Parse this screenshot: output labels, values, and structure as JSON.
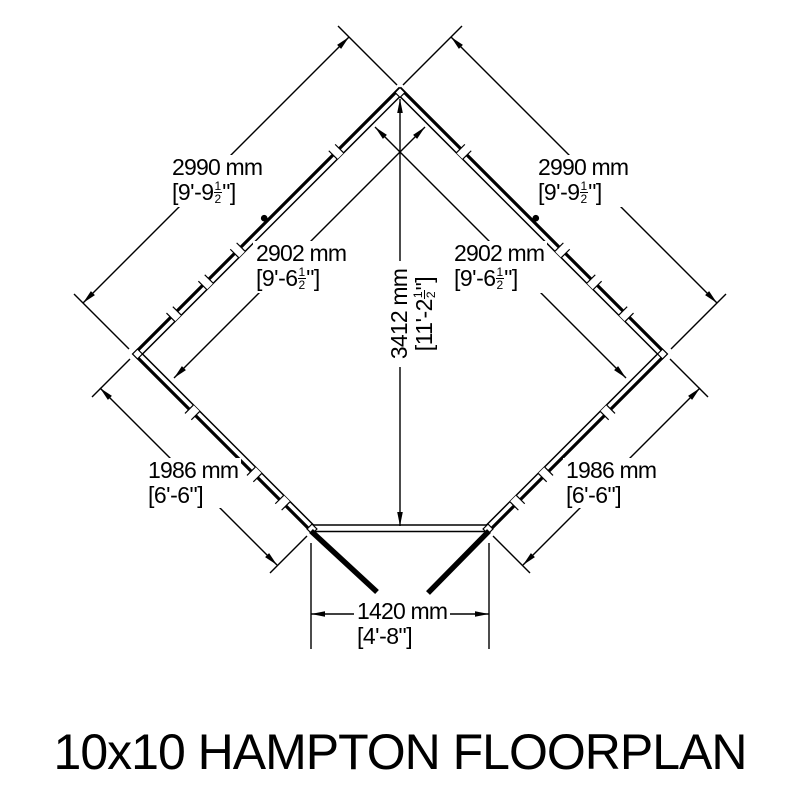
{
  "title": "10x10 HAMPTON FLOORPLAN",
  "drawing": {
    "background_color": "#ffffff",
    "line_color": "#000000",
    "type": "corner-shed floorplan, pentagon outline with double-line walls, open double doors at bottom"
  },
  "dimensions": {
    "wall_2990_left": {
      "metric": "2990 mm",
      "imp_pre": "[9'-9",
      "imp_num": "1",
      "imp_den": "2",
      "imp_post": "\"]"
    },
    "wall_2990_right": {
      "metric": "2990 mm",
      "imp_pre": "[9'-9",
      "imp_num": "1",
      "imp_den": "2",
      "imp_post": "\"]"
    },
    "wall_2902_left": {
      "metric": "2902 mm",
      "imp_pre": "[9'-6",
      "imp_num": "1",
      "imp_den": "2",
      "imp_post": "\"]"
    },
    "wall_2902_right": {
      "metric": "2902 mm",
      "imp_pre": "[9'-6",
      "imp_num": "1",
      "imp_den": "2",
      "imp_post": "\"]"
    },
    "height_3412": {
      "metric": "3412 mm",
      "imp_pre": "[11'-2",
      "imp_num": "1",
      "imp_den": "2",
      "imp_post": "\"]"
    },
    "wall_1986_left": {
      "metric": "1986 mm",
      "imp": "[6'-6\"]"
    },
    "wall_1986_right": {
      "metric": "1986 mm",
      "imp": "[6'-6\"]"
    },
    "door_1420": {
      "metric": "1420 mm",
      "imp": "[4'-8\"]"
    }
  }
}
